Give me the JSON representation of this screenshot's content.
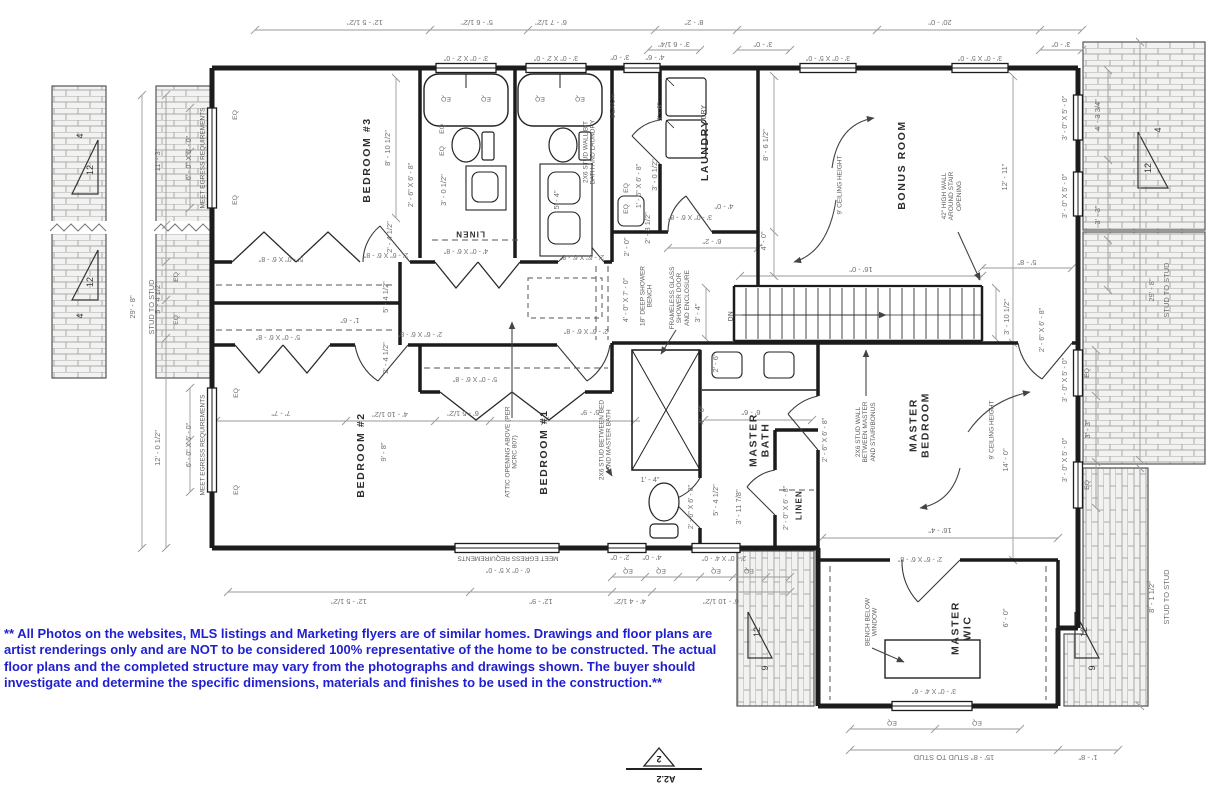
{
  "disclaimer": "** All Photos on the websites, MLS listings and Marketing flyers are of similar homes. Drawings and floor plans are artist renderings only and are NOT to be considered 100% representative of the home to be constructed. The actual floor plans and the completed structure may vary from the photographs and drawings shown. The buyer should investigate and determine the specific dimensions, materials and finishes to be used in the construction.**",
  "sheet_marker": {
    "detail_number": "2",
    "sheet_number": "A2.2"
  },
  "colors": {
    "ink": "#1c1c1c",
    "dim_line": "#999999",
    "note_text": "#5c5c5c",
    "disclaimer_blue": "#1f1fd0",
    "brick_line": "#ababab",
    "brick_fill": "#f2f2f0"
  },
  "rooms": [
    "BEDROOM #3",
    "BEDROOM #2",
    "BEDROOM #1",
    "LAUNDRY",
    "BONUS ROOM",
    "MASTER BEDROOM",
    "MASTER BATH",
    "MASTER WIC",
    "LINEN",
    "LINEN"
  ],
  "labels": [
    {
      "t": "BEDROOM #3",
      "x": 368,
      "y": 160,
      "r": -90,
      "k": "room"
    },
    {
      "t": "BEDROOM #2",
      "x": 362,
      "y": 455,
      "r": -90,
      "k": "room"
    },
    {
      "t": "BEDROOM #1",
      "x": 545,
      "y": 452,
      "r": -90,
      "k": "room"
    },
    {
      "t": "LAUNDRY",
      "x": 706,
      "y": 150,
      "r": -90,
      "k": "room"
    },
    {
      "t": "BONUS ROOM",
      "x": 903,
      "y": 165,
      "r": -90,
      "k": "room"
    },
    {
      "t": "MASTER\nBEDROOM",
      "x": 920,
      "y": 425,
      "r": -90,
      "k": "room"
    },
    {
      "t": "MASTER\nBATH",
      "x": 760,
      "y": 440,
      "r": -90,
      "k": "room"
    },
    {
      "t": "MASTER\nWIC",
      "x": 962,
      "y": 628,
      "r": -90,
      "k": "room"
    },
    {
      "t": "LINEN",
      "x": 470,
      "y": 233,
      "r": 180,
      "k": "closet"
    },
    {
      "t": "LINEN",
      "x": 800,
      "y": 505,
      "r": -90,
      "k": "closet"
    },
    {
      "t": "BENCH",
      "x": 613,
      "y": 106,
      "r": -90,
      "k": "fixture"
    },
    {
      "t": "DRY",
      "x": 704,
      "y": 112,
      "r": -90,
      "k": "fixture"
    },
    {
      "t": "DN",
      "x": 731,
      "y": 316,
      "r": -90,
      "k": "fixture"
    },
    {
      "t": "12' - 5 1/2\"",
      "x": 365,
      "y": 22,
      "r": 180,
      "k": "dim"
    },
    {
      "t": "5' - 6 1/2\"",
      "x": 477,
      "y": 22,
      "r": 180,
      "k": "dim"
    },
    {
      "t": "6' - 7 1/2\"",
      "x": 551,
      "y": 22,
      "r": 180,
      "k": "dim"
    },
    {
      "t": "8' - 2\"",
      "x": 694,
      "y": 22,
      "r": 180,
      "k": "dim"
    },
    {
      "t": "20' - 0\"",
      "x": 940,
      "y": 22,
      "r": 180,
      "k": "dim"
    },
    {
      "t": "3' - 6 1/4\"",
      "x": 674,
      "y": 44,
      "r": 180,
      "k": "dim"
    },
    {
      "t": "3' - 0\"",
      "x": 763,
      "y": 44,
      "r": 180,
      "k": "dim"
    },
    {
      "t": "3' - 0\"",
      "x": 1061,
      "y": 44,
      "r": 180,
      "k": "dim"
    },
    {
      "t": "3' - 0\" X 2' - 0\"",
      "x": 466,
      "y": 57,
      "r": 180,
      "k": "size"
    },
    {
      "t": "3' - 0\" X 2' - 0\"",
      "x": 556,
      "y": 57,
      "r": 180,
      "k": "size"
    },
    {
      "t": "3' - 0\"",
      "x": 620,
      "y": 57,
      "r": 180,
      "k": "dim"
    },
    {
      "t": "4' - 6\"",
      "x": 655,
      "y": 57,
      "r": 180,
      "k": "dim"
    },
    {
      "t": "3' - 0\" X 5' - 0\"",
      "x": 828,
      "y": 57,
      "r": 180,
      "k": "size"
    },
    {
      "t": "3' - 0\" X 5' - 0\"",
      "x": 980,
      "y": 57,
      "r": 180,
      "k": "size"
    },
    {
      "t": "29' - 8\"",
      "x": 133,
      "y": 307,
      "r": -90,
      "k": "dim"
    },
    {
      "t": "STUD TO STUD",
      "x": 152,
      "y": 307,
      "r": -90,
      "k": "dim"
    },
    {
      "t": "11' - 3\"",
      "x": 158,
      "y": 160,
      "r": -90,
      "k": "dim"
    },
    {
      "t": "6' - 0\" X 5' - 0\"",
      "x": 190,
      "y": 158,
      "r": -90,
      "k": "size"
    },
    {
      "t": "MEET EGRESS REQUIREMENTS",
      "x": 203,
      "y": 158,
      "r": -90,
      "k": "note"
    },
    {
      "t": "5' - 4 1/2\"",
      "x": 158,
      "y": 298,
      "r": -90,
      "k": "dim"
    },
    {
      "t": "EQ",
      "x": 177,
      "y": 277,
      "r": -90,
      "k": "eq"
    },
    {
      "t": "EQ",
      "x": 177,
      "y": 320,
      "r": -90,
      "k": "eq"
    },
    {
      "t": "EQ",
      "x": 236,
      "y": 115,
      "r": -90,
      "k": "eq"
    },
    {
      "t": "EQ",
      "x": 236,
      "y": 200,
      "r": -90,
      "k": "eq"
    },
    {
      "t": "12' - 0 1/2\"",
      "x": 158,
      "y": 448,
      "r": -90,
      "k": "dim"
    },
    {
      "t": "6' - 0\" X 5' - 0\"",
      "x": 190,
      "y": 445,
      "r": -90,
      "k": "size"
    },
    {
      "t": "MEET EGRESS REQUIREMENTS",
      "x": 203,
      "y": 445,
      "r": -90,
      "k": "note"
    },
    {
      "t": "EQ",
      "x": 237,
      "y": 393,
      "r": -90,
      "k": "eq"
    },
    {
      "t": "EQ",
      "x": 237,
      "y": 490,
      "r": -90,
      "k": "eq"
    },
    {
      "t": "8' - 10 1/2\"",
      "x": 388,
      "y": 148,
      "r": -90,
      "k": "dim"
    },
    {
      "t": "2' - 6\" X 6' - 8\"",
      "x": 412,
      "y": 185,
      "r": -90,
      "k": "size"
    },
    {
      "t": "3' - 0 1/2\"",
      "x": 444,
      "y": 190,
      "r": -90,
      "k": "dim"
    },
    {
      "t": "EQ",
      "x": 446,
      "y": 98,
      "r": 180,
      "k": "eq"
    },
    {
      "t": "EQ",
      "x": 486,
      "y": 98,
      "r": 180,
      "k": "eq"
    },
    {
      "t": "EQ",
      "x": 540,
      "y": 98,
      "r": 180,
      "k": "eq"
    },
    {
      "t": "EQ",
      "x": 580,
      "y": 98,
      "r": 180,
      "k": "eq"
    },
    {
      "t": "EQ",
      "x": 443,
      "y": 129,
      "r": -90,
      "k": "eq"
    },
    {
      "t": "EQ",
      "x": 443,
      "y": 151,
      "r": -90,
      "k": "eq"
    },
    {
      "t": "5' - 4\"",
      "x": 557,
      "y": 200,
      "r": -90,
      "k": "dim"
    },
    {
      "t": "2X6 STUD WALL B/T\nBATH AND LAUNDRY",
      "x": 590,
      "y": 152,
      "r": -90,
      "k": "note"
    },
    {
      "t": "1' - 6\" X 6' - 8\"",
      "x": 640,
      "y": 186,
      "r": -90,
      "k": "size"
    },
    {
      "t": "3' - 0 1/2\"",
      "x": 655,
      "y": 175,
      "r": -90,
      "k": "dim"
    },
    {
      "t": "5' - 6\"",
      "x": 660,
      "y": 112,
      "r": -90,
      "k": "dim"
    },
    {
      "t": "EQ",
      "x": 627,
      "y": 188,
      "r": -90,
      "k": "eq"
    },
    {
      "t": "EQ",
      "x": 627,
      "y": 209,
      "r": -90,
      "k": "eq"
    },
    {
      "t": "5' - 0\" X 6' - 8\"",
      "x": 281,
      "y": 258,
      "r": 180,
      "k": "size"
    },
    {
      "t": "2' - 6\" X 6' - 8\"",
      "x": 386,
      "y": 254,
      "r": 180,
      "k": "size"
    },
    {
      "t": "4' - 0\" X 6' - 8\"",
      "x": 466,
      "y": 250,
      "r": 180,
      "k": "size"
    },
    {
      "t": "2' - 6\" X 6' - 8\"",
      "x": 582,
      "y": 256,
      "r": 180,
      "k": "size"
    },
    {
      "t": "2' - 4 1/2\"",
      "x": 390,
      "y": 237,
      "r": -90,
      "k": "dim"
    },
    {
      "t": "5' - 4 1/2\"",
      "x": 386,
      "y": 297,
      "r": -90,
      "k": "dim"
    },
    {
      "t": "1' - 6\"",
      "x": 350,
      "y": 320,
      "r": 180,
      "k": "dim"
    },
    {
      "t": "2' - 4 1/2\"",
      "x": 386,
      "y": 358,
      "r": -90,
      "k": "dim"
    },
    {
      "t": "5' - 0\" X 6' - 8\"",
      "x": 278,
      "y": 336,
      "r": 180,
      "k": "size"
    },
    {
      "t": "2' - 6\" X 6' - 8\"",
      "x": 420,
      "y": 333,
      "r": 180,
      "k": "size"
    },
    {
      "t": "2' - 6\" X 6' - 8\"",
      "x": 586,
      "y": 330,
      "r": 180,
      "k": "size"
    },
    {
      "t": "4' - 0\" X 7' - 0\"",
      "x": 627,
      "y": 300,
      "r": -90,
      "k": "size"
    },
    {
      "t": "18\" DEEP SHOWER\nBENCH",
      "x": 647,
      "y": 296,
      "r": -90,
      "k": "note"
    },
    {
      "t": "FRAMELESS GLASS\nSHOWER DOOR\nAND ENCLOSURE",
      "x": 680,
      "y": 298,
      "r": -90,
      "k": "note"
    },
    {
      "t": "2' - 0\"",
      "x": 627,
      "y": 247,
      "r": -90,
      "k": "dim"
    },
    {
      "t": "2' - 8 1/2\"",
      "x": 648,
      "y": 228,
      "r": -90,
      "k": "dim"
    },
    {
      "t": "3' - 0\" X 6' - 8\"",
      "x": 690,
      "y": 216,
      "r": 180,
      "k": "size"
    },
    {
      "t": "4' - 0\"",
      "x": 724,
      "y": 206,
      "r": 180,
      "k": "dim"
    },
    {
      "t": "6' - 2\"",
      "x": 712,
      "y": 241,
      "r": 180,
      "k": "dim"
    },
    {
      "t": "4' - 0\"",
      "x": 764,
      "y": 241,
      "r": -90,
      "k": "dim"
    },
    {
      "t": "8' - 6 1/2\"",
      "x": 766,
      "y": 145,
      "r": -90,
      "k": "dim"
    },
    {
      "t": "16' - 0\"",
      "x": 861,
      "y": 269,
      "r": 180,
      "k": "dim"
    },
    {
      "t": "3' - 4\"",
      "x": 698,
      "y": 313,
      "r": -90,
      "k": "dim"
    },
    {
      "t": "3' - 10 1/2\"",
      "x": 1007,
      "y": 317,
      "r": -90,
      "k": "dim"
    },
    {
      "t": "5' - 8\"",
      "x": 1027,
      "y": 262,
      "r": 180,
      "k": "dim"
    },
    {
      "t": "9' CEILING HEIGHT",
      "x": 840,
      "y": 185,
      "r": -90,
      "k": "note"
    },
    {
      "t": "42\" HIGH WALL\nAROUND STAIR\nOPENING",
      "x": 952,
      "y": 196,
      "r": -90,
      "k": "note"
    },
    {
      "t": "12' - 11\"",
      "x": 1005,
      "y": 177,
      "r": -90,
      "k": "dim"
    },
    {
      "t": "3' - 0\" X 5' - 0\"",
      "x": 1066,
      "y": 118,
      "r": -90,
      "k": "size"
    },
    {
      "t": "3' - 0\" X 5' - 0\"",
      "x": 1066,
      "y": 196,
      "r": -90,
      "k": "size"
    },
    {
      "t": "4' - 3 3/4\"",
      "x": 1098,
      "y": 115,
      "r": -90,
      "k": "dim"
    },
    {
      "t": "3' - 3\"",
      "x": 1098,
      "y": 215,
      "r": -90,
      "k": "dim"
    },
    {
      "t": "29' - 8\"",
      "x": 1152,
      "y": 290,
      "r": -90,
      "k": "dim"
    },
    {
      "t": "STUD TO STUD",
      "x": 1167,
      "y": 290,
      "r": -90,
      "k": "dim"
    },
    {
      "t": "7' - 7\"",
      "x": 281,
      "y": 413,
      "r": 180,
      "k": "dim"
    },
    {
      "t": "4' - 10 1/2\"",
      "x": 390,
      "y": 414,
      "r": 180,
      "k": "dim"
    },
    {
      "t": "9' - 8\"",
      "x": 384,
      "y": 452,
      "r": -90,
      "k": "dim"
    },
    {
      "t": "6' - 5 1/2\"",
      "x": 463,
      "y": 413,
      "r": 180,
      "k": "dim"
    },
    {
      "t": "5' - 9\"",
      "x": 590,
      "y": 412,
      "r": 180,
      "k": "dim"
    },
    {
      "t": "5' - 0\" X 6' - 8\"",
      "x": 475,
      "y": 378,
      "r": 180,
      "k": "size"
    },
    {
      "t": "ATTIC OPENING ABOVE (PER\nNCRC 807)",
      "x": 512,
      "y": 452,
      "r": -90,
      "k": "note"
    },
    {
      "t": "2X6 STUD BETWEEN BED\nAND MASTER BATH",
      "x": 606,
      "y": 440,
      "r": -90,
      "k": "note"
    },
    {
      "t": "2' - 6\"",
      "x": 716,
      "y": 363,
      "r": -90,
      "k": "dim"
    },
    {
      "t": "4' - 0\"",
      "x": 702,
      "y": 415,
      "r": -90,
      "k": "dim"
    },
    {
      "t": "6' - 6\"",
      "x": 751,
      "y": 412,
      "r": 180,
      "k": "dim"
    },
    {
      "t": "1' - 4\"",
      "x": 650,
      "y": 480,
      "r": 0,
      "k": "dim"
    },
    {
      "t": "5' - 4 1/2\"",
      "x": 716,
      "y": 500,
      "r": -90,
      "k": "dim"
    },
    {
      "t": "3' - 11 7/8\"",
      "x": 739,
      "y": 507,
      "r": -90,
      "k": "dim"
    },
    {
      "t": "2' - 6\" X 6' - 8\"",
      "x": 692,
      "y": 507,
      "r": -90,
      "k": "size"
    },
    {
      "t": "2' - 0\" X 6' - 8\"",
      "x": 787,
      "y": 508,
      "r": -90,
      "k": "size"
    },
    {
      "t": "2' - 6\" X 6' - 8\"",
      "x": 826,
      "y": 440,
      "r": -90,
      "k": "size"
    },
    {
      "t": "2X6 STUD WALL\nBETWEEN MASTER\nAND STAIR/BONUS",
      "x": 866,
      "y": 432,
      "r": -90,
      "k": "note"
    },
    {
      "t": "9' CEILING HEIGHT",
      "x": 992,
      "y": 430,
      "r": -90,
      "k": "note"
    },
    {
      "t": "14' - 0\"",
      "x": 1006,
      "y": 460,
      "r": -90,
      "k": "dim"
    },
    {
      "t": "16' - 4\"",
      "x": 940,
      "y": 530,
      "r": 180,
      "k": "dim"
    },
    {
      "t": "2' - 6\" X 6' - 8\"",
      "x": 1043,
      "y": 330,
      "r": -90,
      "k": "size"
    },
    {
      "t": "EQ",
      "x": 1088,
      "y": 373,
      "r": -90,
      "k": "eq"
    },
    {
      "t": "3' - 3\"",
      "x": 1088,
      "y": 429,
      "r": -90,
      "k": "dim"
    },
    {
      "t": "EQ",
      "x": 1088,
      "y": 485,
      "r": -90,
      "k": "eq"
    },
    {
      "t": "3' - 0\" X 5' - 0\"",
      "x": 1066,
      "y": 380,
      "r": -90,
      "k": "size"
    },
    {
      "t": "3' - 0\" X 5' - 0\"",
      "x": 1066,
      "y": 460,
      "r": -90,
      "k": "size"
    },
    {
      "t": "8' - 1 1/2\"",
      "x": 1152,
      "y": 597,
      "r": -90,
      "k": "dim"
    },
    {
      "t": "STUD TO STUD",
      "x": 1167,
      "y": 597,
      "r": -90,
      "k": "dim"
    },
    {
      "t": "12' - 5 1/2\"",
      "x": 349,
      "y": 601,
      "r": 180,
      "k": "dim"
    },
    {
      "t": "12' - 9\"",
      "x": 541,
      "y": 601,
      "r": 180,
      "k": "dim"
    },
    {
      "t": "4' - 4 1/2\"",
      "x": 630,
      "y": 601,
      "r": 180,
      "k": "dim"
    },
    {
      "t": "6' - 10 1/2\"",
      "x": 721,
      "y": 601,
      "r": 180,
      "k": "dim"
    },
    {
      "t": "MEET EGRESS REQUIREMENTS",
      "x": 508,
      "y": 558,
      "r": 180,
      "k": "note"
    },
    {
      "t": "6' - 0\" X 5' - 0\"",
      "x": 508,
      "y": 569,
      "r": 180,
      "k": "size"
    },
    {
      "t": "2' - 0\"",
      "x": 620,
      "y": 557,
      "r": 180,
      "k": "dim"
    },
    {
      "t": "4' - 0\"",
      "x": 652,
      "y": 557,
      "r": 180,
      "k": "dim"
    },
    {
      "t": "2' - 0\" X 4' - 0\"",
      "x": 724,
      "y": 557,
      "r": 180,
      "k": "size"
    },
    {
      "t": "EQ",
      "x": 628,
      "y": 570,
      "r": 180,
      "k": "eq"
    },
    {
      "t": "EQ",
      "x": 661,
      "y": 570,
      "r": 180,
      "k": "eq"
    },
    {
      "t": "EQ",
      "x": 716,
      "y": 570,
      "r": 180,
      "k": "eq"
    },
    {
      "t": "EQ",
      "x": 749,
      "y": 570,
      "r": 180,
      "k": "eq"
    },
    {
      "t": "BENCH BELOW\nWINDOW",
      "x": 872,
      "y": 622,
      "r": -90,
      "k": "note"
    },
    {
      "t": "6' - 0\"",
      "x": 1006,
      "y": 618,
      "r": -90,
      "k": "dim"
    },
    {
      "t": "2' - 6\" X 6' - 8\"",
      "x": 920,
      "y": 558,
      "r": 180,
      "k": "size"
    },
    {
      "t": "3' - 0\" X 4' - 6\"",
      "x": 934,
      "y": 690,
      "r": 180,
      "k": "size"
    },
    {
      "t": "EQ",
      "x": 892,
      "y": 722,
      "r": 180,
      "k": "eq"
    },
    {
      "t": "EQ",
      "x": 977,
      "y": 722,
      "r": 180,
      "k": "eq"
    },
    {
      "t": "15' - 8\" STUD TO STUD",
      "x": 954,
      "y": 757,
      "r": 180,
      "k": "dim"
    },
    {
      "t": "1' - 8\"",
      "x": 1088,
      "y": 757,
      "r": 180,
      "k": "dim"
    },
    {
      "t": "12",
      "x": 90,
      "y": 170,
      "r": -90,
      "k": "pitch"
    },
    {
      "t": "4",
      "x": 80,
      "y": 136,
      "r": -90,
      "k": "pitch"
    },
    {
      "t": "12",
      "x": 90,
      "y": 282,
      "r": -90,
      "k": "pitch"
    },
    {
      "t": "4",
      "x": 80,
      "y": 316,
      "r": -90,
      "k": "pitch"
    },
    {
      "t": "12",
      "x": 1148,
      "y": 168,
      "r": -90,
      "k": "pitch"
    },
    {
      "t": "4",
      "x": 1158,
      "y": 130,
      "r": -90,
      "k": "pitch"
    },
    {
      "t": "12",
      "x": 757,
      "y": 632,
      "r": -90,
      "k": "pitch"
    },
    {
      "t": "9",
      "x": 765,
      "y": 668,
      "r": -90,
      "k": "pitch"
    },
    {
      "t": "12",
      "x": 1084,
      "y": 632,
      "r": -90,
      "k": "pitch"
    },
    {
      "t": "9",
      "x": 1092,
      "y": 668,
      "r": -90,
      "k": "pitch"
    }
  ]
}
